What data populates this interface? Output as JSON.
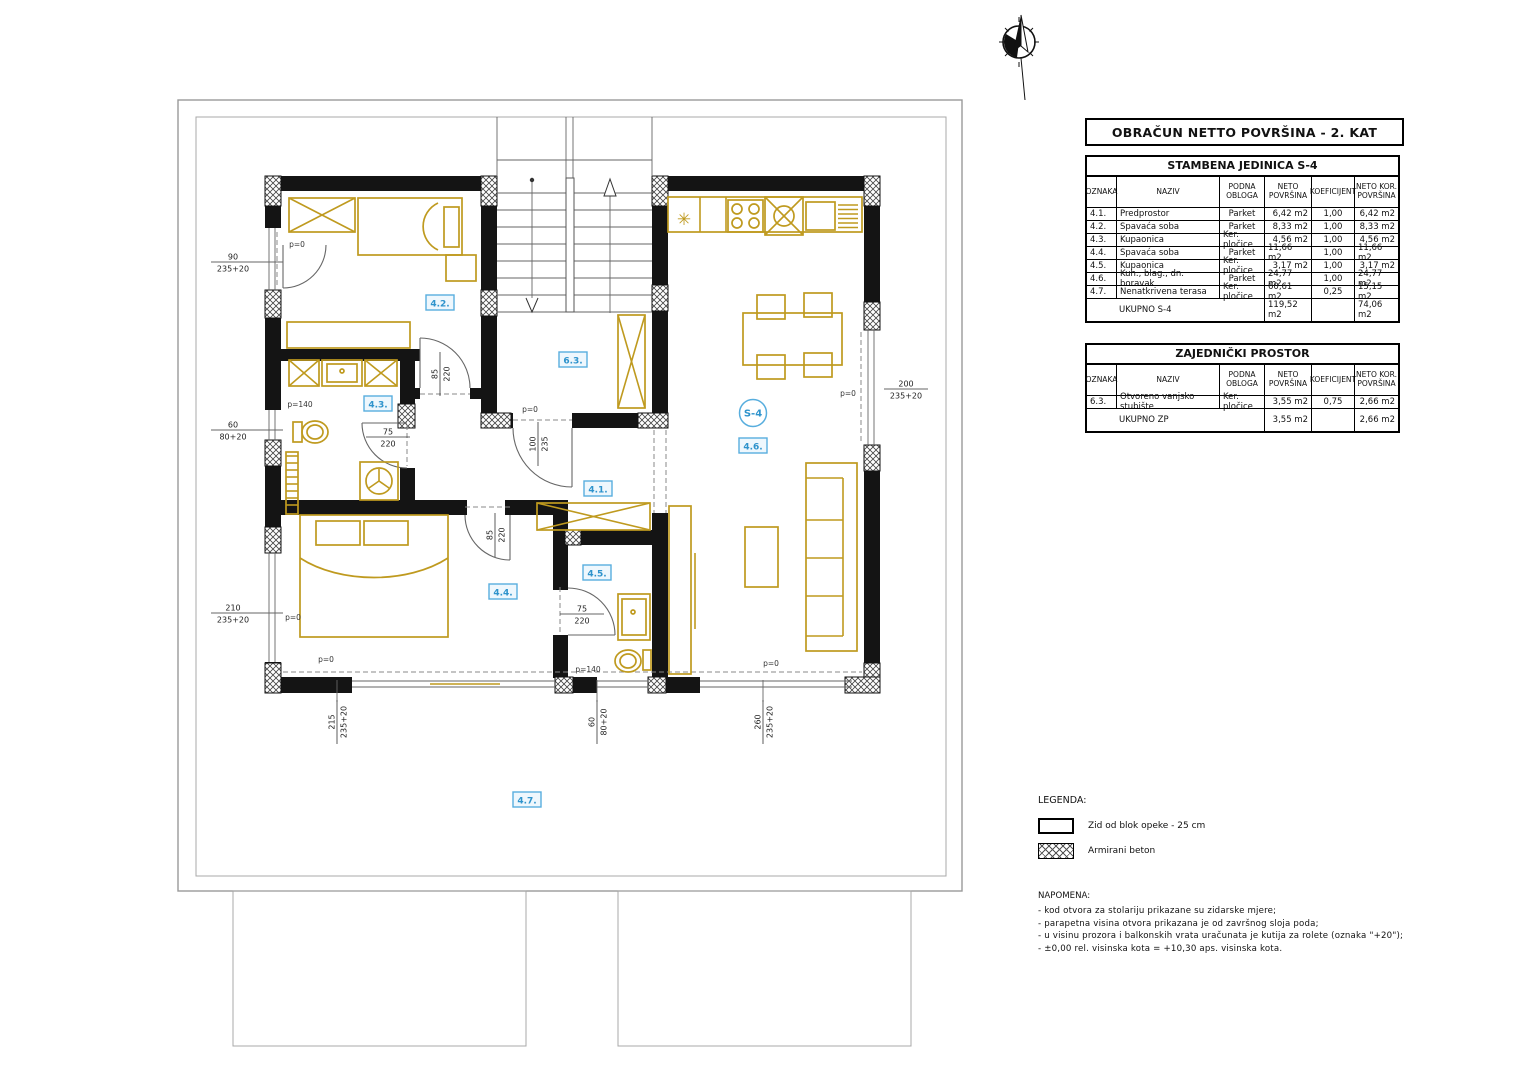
{
  "title_block": {
    "title": "OBRAČUN NETTO POVRŠINA - 2. KAT"
  },
  "tables": [
    {
      "title": "STAMBENA JEDINICA S-4",
      "headers": [
        "OZNAKA",
        "NAZIV",
        "PODNA OBLOGA",
        "NETO POVRŠINA",
        "KOEFICIJENT",
        "NETO KOR. POVRŠINA"
      ],
      "rows": [
        [
          "4.1.",
          "Predprostor",
          "Parket",
          "6,42 m2",
          "1,00",
          "6,42 m2"
        ],
        [
          "4.2.",
          "Spavaća soba",
          "Parket",
          "8,33 m2",
          "1,00",
          "8,33 m2"
        ],
        [
          "4.3.",
          "Kupaonica",
          "Ker. pločice",
          "4,56 m2",
          "1,00",
          "4,56 m2"
        ],
        [
          "4.4.",
          "Spavaća soba",
          "Parket",
          "11,66 m2",
          "1,00",
          "11,66 m2"
        ],
        [
          "4.5.",
          "Kupaonica",
          "Ker. pločice",
          "3,17 m2",
          "1,00",
          "3,17 m2"
        ],
        [
          "4.6.",
          "Kuh., blag., dn. boravak",
          "Parket",
          "24,77 m2",
          "1,00",
          "24,77 m2"
        ],
        [
          "4.7.",
          "Nenatkrivena terasa",
          "Ker. pločice",
          "60,61 m2",
          "0,25",
          "15,15 m2"
        ]
      ],
      "total": {
        "label": "UKUPNO S-4",
        "neto": "119,52 m2",
        "kor": "74,06 m2"
      }
    },
    {
      "title": "ZAJEDNIČKI PROSTOR",
      "headers": [
        "OZNAKA",
        "NAZIV",
        "PODNA OBLOGA",
        "NETO POVRŠINA",
        "KOEFICIJENT",
        "NETO KOR. POVRŠINA"
      ],
      "rows": [
        [
          "6.3.",
          "Otvoreno vanjsko stubište",
          "Ker. pločice",
          "3,55 m2",
          "0,75",
          "2,66 m2"
        ]
      ],
      "total": {
        "label": "UKUPNO ZP",
        "neto": "3,55 m2",
        "kor": "2,66 m2"
      }
    }
  ],
  "legend": {
    "title": "LEGENDA:",
    "items": [
      {
        "symbol": "brick-wall",
        "label": "Zid od blok opeke - 25 cm"
      },
      {
        "symbol": "reinforced-concrete",
        "label": "Armirani beton"
      }
    ]
  },
  "notes": {
    "title": "NAPOMENA:",
    "lines": [
      "- kod otvora za stolariju prikazane su zidarske mjere;",
      "- parapetna visina otvora prikazana je od završnog sloja poda;",
      "- u visinu prozora i balkonskih vrata uračunata je kutija za rolete (oznaka \"+20\");",
      "- ±0,00 rel. visinska kota = +10,30 aps. visinska kota."
    ]
  },
  "plan": {
    "unit_label": "S-4",
    "unit_circle": {
      "x": 753,
      "y": 413
    },
    "room_labels": [
      {
        "id": "4.1.",
        "x": 598,
        "y": 489
      },
      {
        "id": "4.2.",
        "x": 440,
        "y": 303
      },
      {
        "id": "4.3.",
        "x": 378,
        "y": 404
      },
      {
        "id": "4.4.",
        "x": 503,
        "y": 592
      },
      {
        "id": "4.5.",
        "x": 597,
        "y": 573
      },
      {
        "id": "4.6.",
        "x": 753,
        "y": 446
      },
      {
        "id": "4.7.",
        "x": 527,
        "y": 800
      },
      {
        "id": "6.3.",
        "x": 573,
        "y": 360
      }
    ],
    "dims": [
      {
        "top": "90",
        "bottom": "235+20",
        "x": 233,
        "y": 262,
        "rot": 0
      },
      {
        "top": "60",
        "bottom": "80+20",
        "x": 233,
        "y": 430,
        "rot": 0
      },
      {
        "top": "210",
        "bottom": "235+20",
        "x": 233,
        "y": 613,
        "rot": 0
      },
      {
        "top": "200",
        "bottom": "235+20",
        "x": 906,
        "y": 389,
        "rot": 0
      },
      {
        "top": "215",
        "bottom": "235+20",
        "x": 337,
        "y": 722,
        "rot": -90
      },
      {
        "top": "60",
        "bottom": "80+20",
        "x": 597,
        "y": 722,
        "rot": -90
      },
      {
        "top": "260",
        "bottom": "235+20",
        "x": 763,
        "y": 722,
        "rot": -90
      },
      {
        "top": "85",
        "bottom": "220",
        "x": 440,
        "y": 374,
        "rot": -90
      },
      {
        "top": "75",
        "bottom": "220",
        "x": 388,
        "y": 437,
        "rot": 0
      },
      {
        "top": "100",
        "bottom": "235",
        "x": 538,
        "y": 444,
        "rot": -90
      },
      {
        "top": "85",
        "bottom": "220",
        "x": 495,
        "y": 535,
        "rot": -90
      },
      {
        "top": "75",
        "bottom": "220",
        "x": 582,
        "y": 614,
        "rot": 0
      }
    ],
    "p_labels": [
      {
        "text": "p=0",
        "x": 297,
        "y": 247
      },
      {
        "text": "p=140",
        "x": 300,
        "y": 407
      },
      {
        "text": "p=0",
        "x": 293,
        "y": 620
      },
      {
        "text": "p=0",
        "x": 530,
        "y": 412
      },
      {
        "text": "p=0",
        "x": 848,
        "y": 396
      },
      {
        "text": "p=0",
        "x": 326,
        "y": 662
      },
      {
        "text": "p=140",
        "x": 588,
        "y": 672
      },
      {
        "text": "p=0",
        "x": 771,
        "y": 666
      }
    ],
    "symbols": [
      {
        "text": "✳",
        "x": 684,
        "y": 225,
        "name": "kitchen-sink-symbol"
      }
    ],
    "colors": {
      "wall": "#141414",
      "furniture": "#bf9a1f",
      "label_blue": "#3d9fd6",
      "thin_line": "#666666"
    }
  }
}
